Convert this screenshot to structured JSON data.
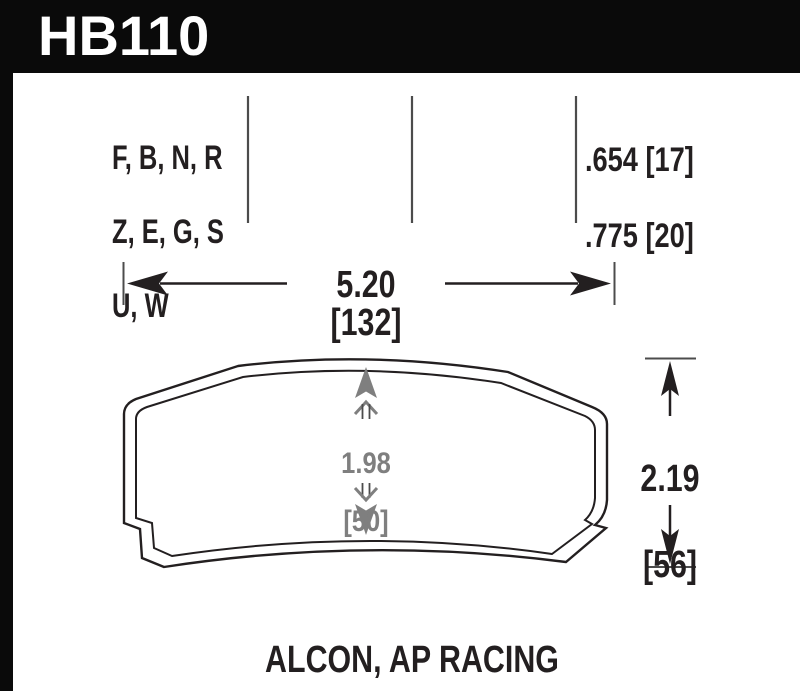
{
  "header": {
    "part_number": "HB110"
  },
  "spec_table": {
    "compound_lines": [
      "F, B, N, R",
      "Z, E, G, S",
      "U, W"
    ],
    "thickness_lines": [
      ".654 [17]",
      ".775 [20]"
    ]
  },
  "dimensions": {
    "width": "5.20 [132]",
    "pad_inner_height_value": "1.98",
    "pad_inner_height_mm": "[50]",
    "overall_height_value": "2.19",
    "overall_height_mm": "[56]"
  },
  "footer": {
    "applications": "ALCON, AP RACING"
  },
  "colors": {
    "header_bg": "#0a0a0a",
    "text_on_dark": "#ffffff",
    "ink": "#231f20",
    "divider_gray": "#4c4c4c",
    "dim_gray": "#7f7f7f",
    "background": "#ffffff"
  }
}
